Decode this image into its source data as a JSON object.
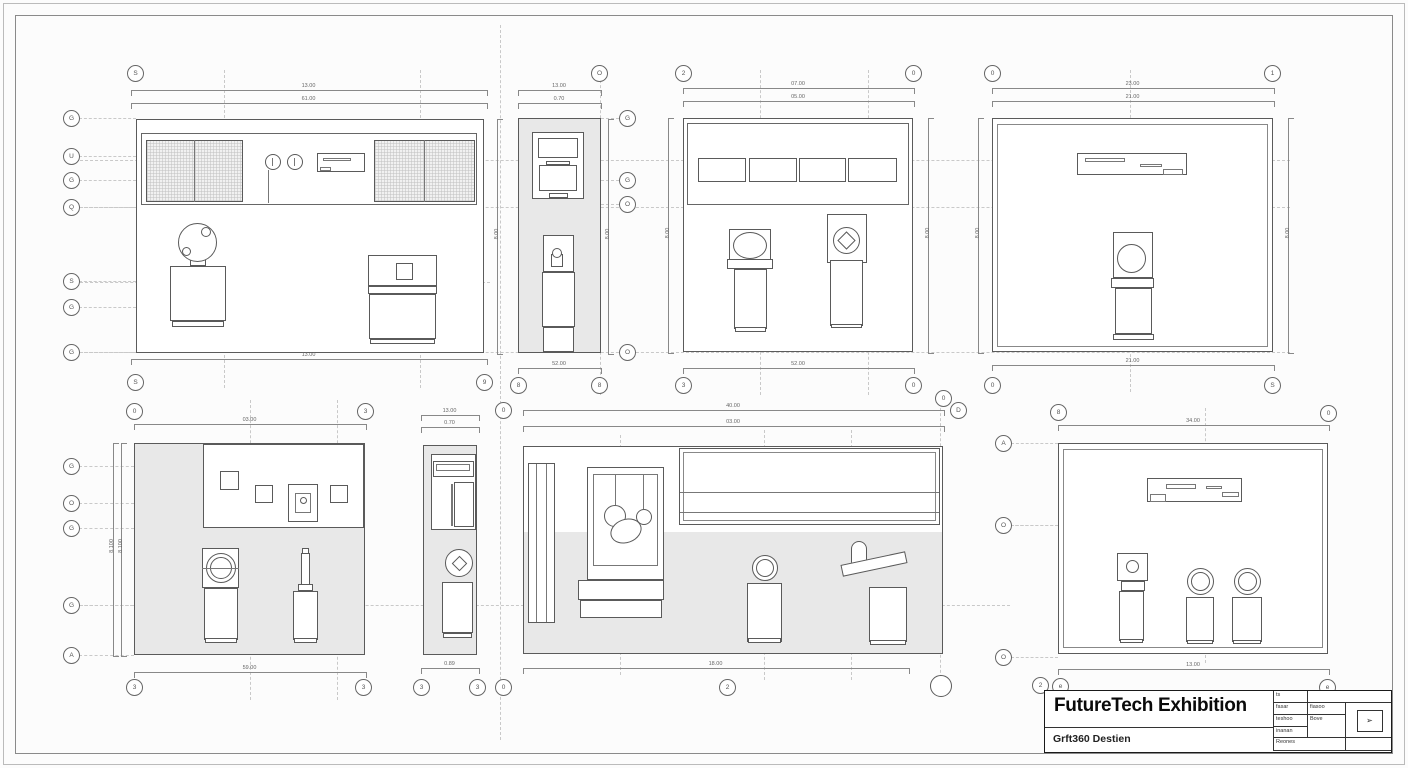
{
  "colors": {
    "paper": "#fcfcfc",
    "line": "#5a5a5a",
    "fill_gray": "#e8e8e8",
    "dash": "#c9c9c9",
    "title_text": "#0a0a0a"
  },
  "sheet": {
    "title": "FutureTech Exhibition",
    "subtitle": "Grft360 Destien"
  },
  "title_block": {
    "col1": [
      "ts",
      "fasar",
      "teshoo",
      "inanan",
      "Reones"
    ],
    "col2_row2": "fiasoo",
    "col2_row34": "Bove",
    "stamp_icon": "cursor-icon",
    "stamp_glyph": "➢"
  },
  "views": {
    "v1": {
      "dims": {
        "top1": "13.00",
        "top2": "61.00",
        "bottom": "13.00",
        "right": "8.00"
      },
      "bubbles": {
        "top": [
          "S"
        ],
        "left": [
          "G",
          "U",
          "G",
          "Q",
          "S",
          "G",
          "G"
        ],
        "bottom": [
          "S",
          "9"
        ]
      }
    },
    "v2": {
      "dims": {
        "top1": "13.00",
        "top2": "0.70",
        "bottom": "52.00",
        "right": "8.00"
      },
      "bubbles": {
        "top": [
          "O"
        ],
        "right": [
          "G",
          "G",
          "O",
          "O"
        ],
        "bottom": [
          "8",
          "8"
        ]
      }
    },
    "v3": {
      "dims": {
        "top1": "07.00",
        "top2": "05.00",
        "bottom": "52.00",
        "left": "8.00",
        "right": "8.00"
      },
      "bubbles": {
        "top": [
          "2",
          "0"
        ],
        "bottom": [
          "3",
          "0"
        ]
      }
    },
    "v4": {
      "dims": {
        "top1": "23.00",
        "top2": "21.00",
        "bottom": "21.00",
        "left": "8.00",
        "right": "8.00"
      },
      "bubbles": {
        "top": [
          "0",
          "1"
        ],
        "bottom": [
          "0",
          "S"
        ]
      }
    },
    "v5": {
      "dims": {
        "top": "03.00",
        "bottom": "59.00",
        "left1": "8.100",
        "left2": "8.100"
      },
      "bubbles": {
        "top": [
          "0",
          "3"
        ],
        "left": [
          "G",
          "O",
          "G",
          "G",
          "A"
        ],
        "bottom": [
          "3",
          "3"
        ]
      }
    },
    "v6": {
      "dims": {
        "top1": "13.00",
        "top2": "0.70",
        "bottom": "0.89"
      },
      "bubbles": {
        "top": [
          "0"
        ],
        "bottom": [
          "3",
          "3",
          "0"
        ]
      }
    },
    "v7": {
      "dims": {
        "top1": "40.00",
        "top2": "03.00",
        "bottom": "18.00"
      },
      "bubbles": {
        "top": [
          "0",
          "D"
        ],
        "bottom": [
          "2"
        ]
      }
    },
    "v8": {
      "dims": {
        "top": "34.00",
        "bottom": "13.00"
      },
      "bubbles": {
        "top": [
          "8",
          "0"
        ],
        "left": [
          "A",
          "O",
          "O"
        ],
        "bottom": [
          "2",
          "e",
          "e"
        ]
      }
    }
  }
}
